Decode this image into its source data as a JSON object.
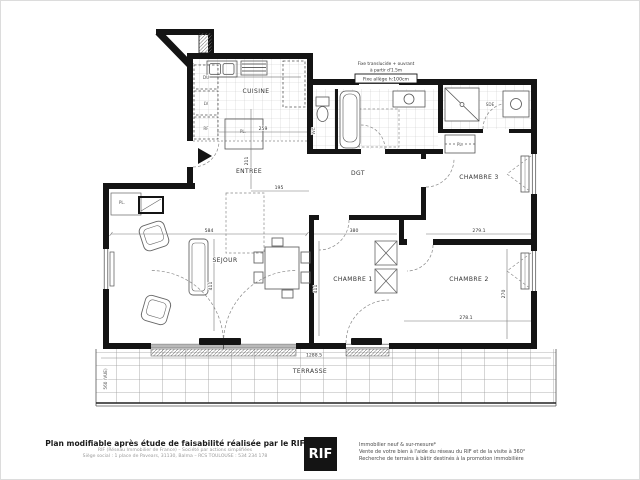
{
  "plan": {
    "rooms": {
      "cuisine": "CUISINE",
      "entree": "ENTREE",
      "sejour": "SEJOUR",
      "dgt": "DGT",
      "chambre1": "CHAMBRE 1",
      "chambre2": "CHAMBRE 2",
      "chambre3": "CHAMBRE 3",
      "terrasse": "TERRASSE",
      "wc": "WC",
      "sde": "SDE"
    },
    "closets": {
      "entree": "PL.",
      "sejour": "PL.",
      "chambre3": "PL."
    },
    "appliances": {
      "a1": "DU",
      "a2": "LV",
      "a3": "RF"
    },
    "annotation": {
      "line1": "Fixe translucide + ouvrant",
      "line2": "à partir d'1.5m",
      "tag": "Fixe allège h:100cm"
    },
    "dims": {
      "sejour_w": "584",
      "sejour_h": "411",
      "ch1_w": "380",
      "ch1_h": "411",
      "ch2_w_top": "279.1",
      "ch2_w_bot": "278.1",
      "ch2_h": "270",
      "cuisine_w": "259",
      "entree_h": "211",
      "entree_w": "195",
      "terrasse_w": "1288.5",
      "terrasse_side": "560 (VUE)"
    }
  },
  "footer": {
    "left": {
      "title": "Plan modifiable après étude de faisabilité réalisée par le RIF",
      "line1": "RIF (Réseau Immobilier de France) – Société par actions simplifiées",
      "line2": "Siège social : 1 place de Pavears, 31130, Balma – RCS TOULOUSE : 534 234 178"
    },
    "logo": {
      "text": "RIF",
      "bg": "#141414",
      "fg": "#ffffff"
    },
    "right": {
      "line1": "Immobilier neuf & sur-mesure*",
      "line2": "Vente de votre bien à l'aide du réseau du RIF et de la visite à 360°",
      "line3": "Recherche de terrains à bâtir destinés à la promotion immobilière"
    }
  }
}
